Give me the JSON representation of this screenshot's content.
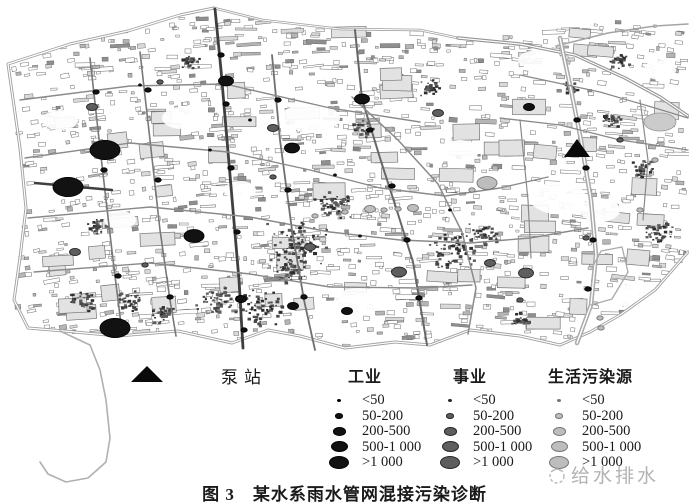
{
  "figure": {
    "caption": "图 3　某水系雨水管网混接污染诊断"
  },
  "watermark": {
    "text": "给水排水"
  },
  "legend": {
    "pump_label": "泵站",
    "columns": [
      {
        "key": "industry",
        "label": "工业",
        "items": [
          {
            "label": "<50"
          },
          {
            "label": "50-200"
          },
          {
            "label": "200-500"
          },
          {
            "label": "500-1 000"
          },
          {
            "label": ">1 000"
          }
        ]
      },
      {
        "key": "institution",
        "label": "事业",
        "items": [
          {
            "label": "<50"
          },
          {
            "label": "50-200"
          },
          {
            "label": "200-500"
          },
          {
            "label": "500-1 000"
          },
          {
            "label": ">1 000"
          }
        ]
      },
      {
        "key": "domestic",
        "label": "生活污染源",
        "items": [
          {
            "label": "<50"
          },
          {
            "label": "50-200"
          },
          {
            "label": "200-500"
          },
          {
            "label": "500-1 000"
          },
          {
            "label": ">1 000"
          }
        ]
      }
    ]
  },
  "colors": {
    "industry": {
      "fill": "#121212",
      "edge": "#000000"
    },
    "institution": {
      "fill": "#5e5e5e",
      "edge": "#262626"
    },
    "domestic": {
      "fill": "#bdbdbd",
      "edge": "#757575"
    },
    "road": "#8a8a8a",
    "dark_road": "#3f3f3f",
    "boundary": "#9f9f9f"
  },
  "chart_data": {
    "type": "map",
    "title": "图 3　某水系雨水管网混接污染诊断",
    "legend": {
      "pump_station": "泵站",
      "categories": [
        "工业",
        "事业",
        "生活污染源"
      ],
      "size_classes": [
        "<50",
        "50-200",
        "200-500",
        "500-1 000",
        ">1 000"
      ]
    },
    "pump_stations_px": [
      {
        "x": 577,
        "y": 149
      }
    ],
    "sources_px": [
      {
        "x": 105,
        "y": 150,
        "cat": "industry",
        "cls": 4,
        "xl": true
      },
      {
        "x": 68,
        "y": 187,
        "cat": "industry",
        "cls": 4,
        "xl": true
      },
      {
        "x": 115,
        "y": 328,
        "cat": "industry",
        "cls": 4,
        "xl": true
      },
      {
        "x": 194,
        "y": 236,
        "cat": "industry",
        "cls": 4
      },
      {
        "x": 226,
        "y": 81,
        "cat": "industry",
        "cls": 3
      },
      {
        "x": 362,
        "y": 99,
        "cat": "industry",
        "cls": 3
      },
      {
        "x": 292,
        "y": 148,
        "cat": "industry",
        "cls": 3
      },
      {
        "x": 529,
        "y": 107,
        "cat": "industry",
        "cls": 2
      },
      {
        "x": 293,
        "y": 306,
        "cat": "industry",
        "cls": 2
      },
      {
        "x": 347,
        "y": 311,
        "cat": "industry",
        "cls": 2
      },
      {
        "x": 241,
        "y": 299,
        "cat": "industry",
        "cls": 2
      },
      {
        "x": 221,
        "y": 55,
        "cat": "industry",
        "cls": 1
      },
      {
        "x": 226,
        "y": 104,
        "cat": "industry",
        "cls": 1
      },
      {
        "x": 231,
        "y": 168,
        "cat": "industry",
        "cls": 1
      },
      {
        "x": 237,
        "y": 232,
        "cat": "industry",
        "cls": 1
      },
      {
        "x": 244,
        "y": 330,
        "cat": "industry",
        "cls": 1
      },
      {
        "x": 96,
        "y": 92,
        "cat": "industry",
        "cls": 1
      },
      {
        "x": 104,
        "y": 170,
        "cat": "industry",
        "cls": 1
      },
      {
        "x": 118,
        "y": 276,
        "cat": "industry",
        "cls": 1
      },
      {
        "x": 148,
        "y": 90,
        "cat": "industry",
        "cls": 1
      },
      {
        "x": 158,
        "y": 180,
        "cat": "industry",
        "cls": 1
      },
      {
        "x": 170,
        "y": 297,
        "cat": "industry",
        "cls": 1
      },
      {
        "x": 278,
        "y": 100,
        "cat": "industry",
        "cls": 1
      },
      {
        "x": 288,
        "y": 190,
        "cat": "industry",
        "cls": 1
      },
      {
        "x": 304,
        "y": 297,
        "cat": "industry",
        "cls": 1
      },
      {
        "x": 370,
        "y": 130,
        "cat": "industry",
        "cls": 1
      },
      {
        "x": 392,
        "y": 186,
        "cat": "industry",
        "cls": 1
      },
      {
        "x": 407,
        "y": 240,
        "cat": "industry",
        "cls": 1
      },
      {
        "x": 419,
        "y": 298,
        "cat": "industry",
        "cls": 1
      },
      {
        "x": 577,
        "y": 120,
        "cat": "industry",
        "cls": 1
      },
      {
        "x": 586,
        "y": 168,
        "cat": "industry",
        "cls": 1
      },
      {
        "x": 593,
        "y": 240,
        "cat": "industry",
        "cls": 1
      },
      {
        "x": 588,
        "y": 289,
        "cat": "industry",
        "cls": 1
      },
      {
        "x": 335,
        "y": 175,
        "cat": "industry",
        "cls": 0
      },
      {
        "x": 210,
        "y": 150,
        "cat": "industry",
        "cls": 0
      },
      {
        "x": 300,
        "y": 228,
        "cat": "industry",
        "cls": 0
      },
      {
        "x": 360,
        "y": 236,
        "cat": "industry",
        "cls": 0
      },
      {
        "x": 140,
        "y": 85,
        "cat": "industry",
        "cls": 0
      },
      {
        "x": 250,
        "y": 120,
        "cat": "industry",
        "cls": 0
      },
      {
        "x": 450,
        "y": 210,
        "cat": "industry",
        "cls": 0
      },
      {
        "x": 92,
        "y": 107,
        "cat": "institution",
        "cls": 2
      },
      {
        "x": 273,
        "y": 128,
        "cat": "institution",
        "cls": 2
      },
      {
        "x": 273,
        "y": 177,
        "cat": "institution",
        "cls": 1
      },
      {
        "x": 310,
        "y": 247,
        "cat": "institution",
        "cls": 2
      },
      {
        "x": 399,
        "y": 272,
        "cat": "institution",
        "cls": 3
      },
      {
        "x": 490,
        "y": 263,
        "cat": "institution",
        "cls": 2
      },
      {
        "x": 526,
        "y": 273,
        "cat": "institution",
        "cls": 3
      },
      {
        "x": 586,
        "y": 238,
        "cat": "institution",
        "cls": 1
      },
      {
        "x": 438,
        "y": 113,
        "cat": "institution",
        "cls": 2
      },
      {
        "x": 75,
        "y": 252,
        "cat": "institution",
        "cls": 2
      },
      {
        "x": 145,
        "y": 265,
        "cat": "institution",
        "cls": 1
      },
      {
        "x": 160,
        "y": 82,
        "cat": "institution",
        "cls": 1
      },
      {
        "x": 520,
        "y": 300,
        "cat": "institution",
        "cls": 1
      },
      {
        "x": 620,
        "y": 140,
        "cat": "institution",
        "cls": 1
      },
      {
        "x": 487,
        "y": 183,
        "cat": "domestic",
        "cls": 4
      },
      {
        "x": 472,
        "y": 190,
        "cat": "domestic",
        "cls": 1
      },
      {
        "x": 370,
        "y": 209,
        "cat": "domestic",
        "cls": 2
      },
      {
        "x": 384,
        "y": 210,
        "cat": "domestic",
        "cls": 1
      },
      {
        "x": 398,
        "y": 209,
        "cat": "domestic",
        "cls": 1
      },
      {
        "x": 413,
        "y": 208,
        "cat": "domestic",
        "cls": 2
      },
      {
        "x": 345,
        "y": 212,
        "cat": "domestic",
        "cls": 1
      },
      {
        "x": 315,
        "y": 216,
        "cat": "domestic",
        "cls": 1
      },
      {
        "x": 600,
        "y": 318,
        "cat": "domestic",
        "cls": 1
      },
      {
        "x": 601,
        "y": 328,
        "cat": "domestic",
        "cls": 1
      },
      {
        "x": 640,
        "y": 210,
        "cat": "domestic",
        "cls": 1
      },
      {
        "x": 655,
        "y": 160,
        "cat": "domestic",
        "cls": 1
      }
    ]
  }
}
